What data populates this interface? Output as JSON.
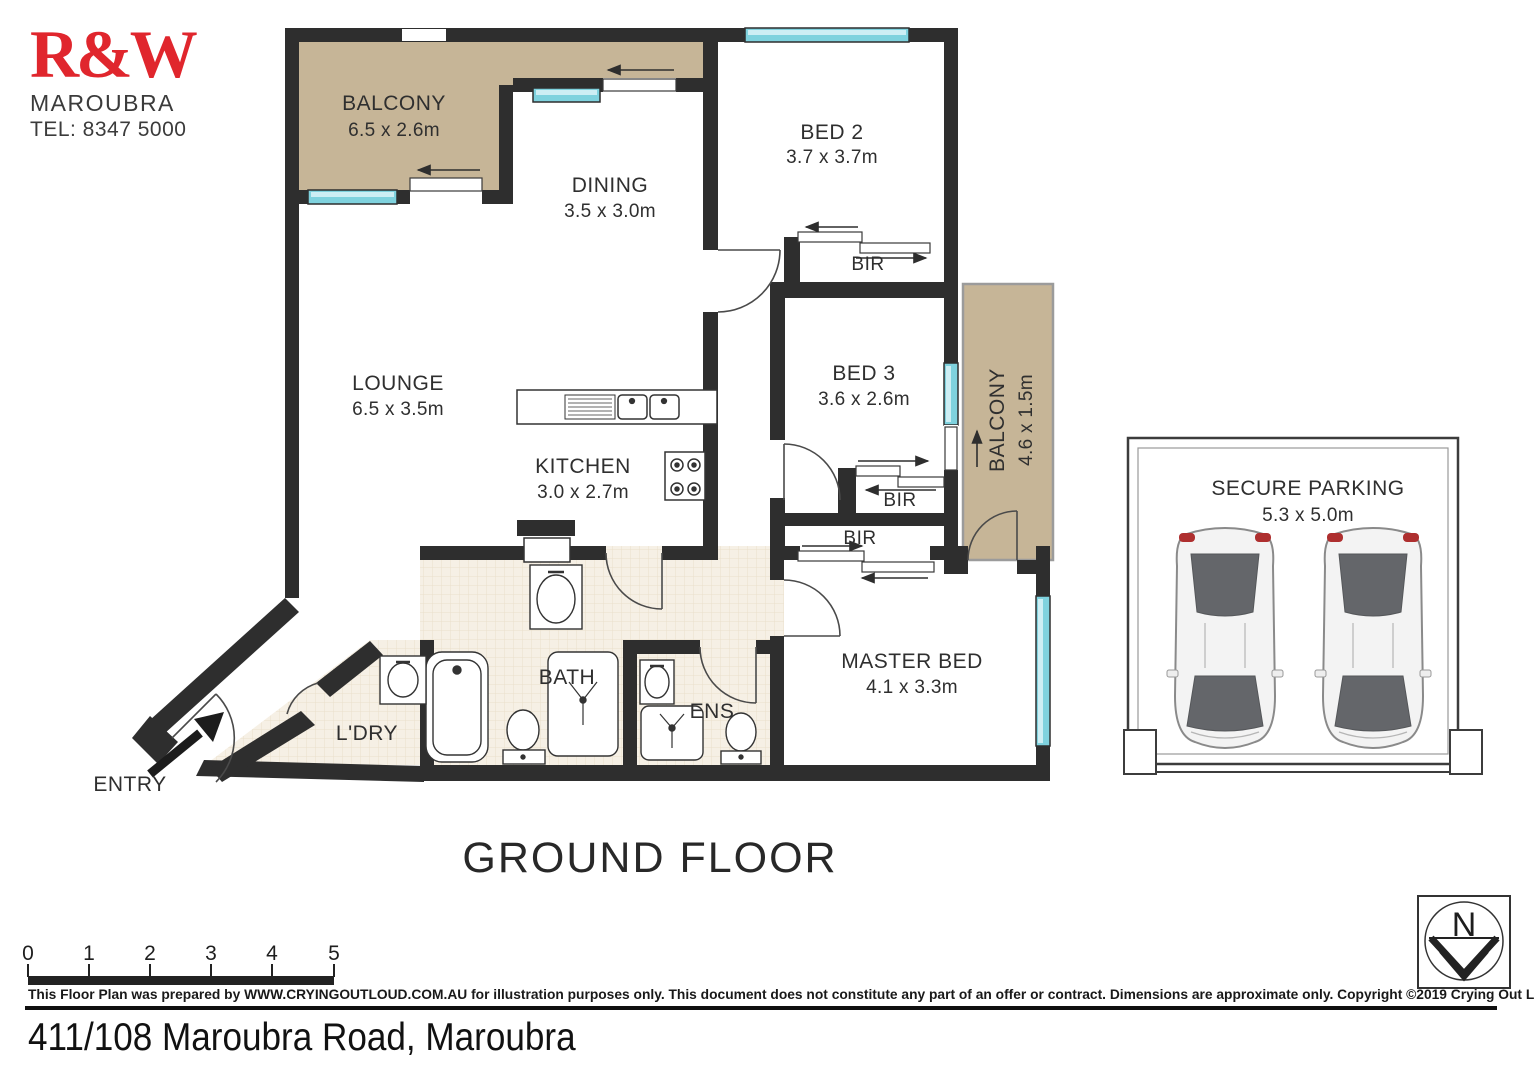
{
  "branding": {
    "logo_text": "R&W",
    "office_name": "MAROUBRA",
    "phone": "TEL: 8347 5000"
  },
  "plan": {
    "floor_title": "GROUND FLOOR",
    "rooms": {
      "balcony_top": {
        "label": "BALCONY",
        "dims": "6.5 x 2.6m"
      },
      "dining": {
        "label": "DINING",
        "dims": "3.5 x 3.0m"
      },
      "bed2": {
        "label": "BED 2",
        "dims": "3.7 x 3.7m"
      },
      "bed2_bir": {
        "label": "BIR"
      },
      "bed3": {
        "label": "BED 3",
        "dims": "3.6 x 2.6m"
      },
      "balcony_side": {
        "label": "BALCONY",
        "dims": "4.6 x 1.5m"
      },
      "bed3_bir": {
        "label": "BIR"
      },
      "master_bir": {
        "label": "BIR"
      },
      "lounge": {
        "label": "LOUNGE",
        "dims": "6.5 x 3.5m"
      },
      "kitchen": {
        "label": "KITCHEN",
        "dims": "3.0 x 2.7m"
      },
      "master_bed": {
        "label": "MASTER BED",
        "dims": "4.1 x 3.3m"
      },
      "bath": {
        "label": "BATH"
      },
      "ens": {
        "label": "ENS"
      },
      "laundry": {
        "label": "L'DRY"
      },
      "entry": {
        "label": "ENTRY"
      }
    }
  },
  "parking": {
    "label": "SECURE PARKING",
    "dims": "5.3 x 5.0m"
  },
  "scale_bar": {
    "ticks": [
      "0",
      "1",
      "2",
      "3",
      "4",
      "5"
    ]
  },
  "compass": {
    "north": "N"
  },
  "footer": {
    "disclaimer": "This Floor Plan was prepared by WWW.CRYINGOUTLOUD.COM.AU for illustration purposes only. This document does not constitute any part of an offer or contract. Dimensions are approximate only. Copyright ©2019 Crying Out Loud. All Rights Reserved.",
    "address": "411/108 Maroubra Road, Maroubra"
  },
  "colors": {
    "brand_red": "#e0262d",
    "wall": "#2e2e2e",
    "balcony_fill": "#c6b597",
    "window_glass": "#7fd2de",
    "wet_area_floor": "#f6f0e5"
  }
}
